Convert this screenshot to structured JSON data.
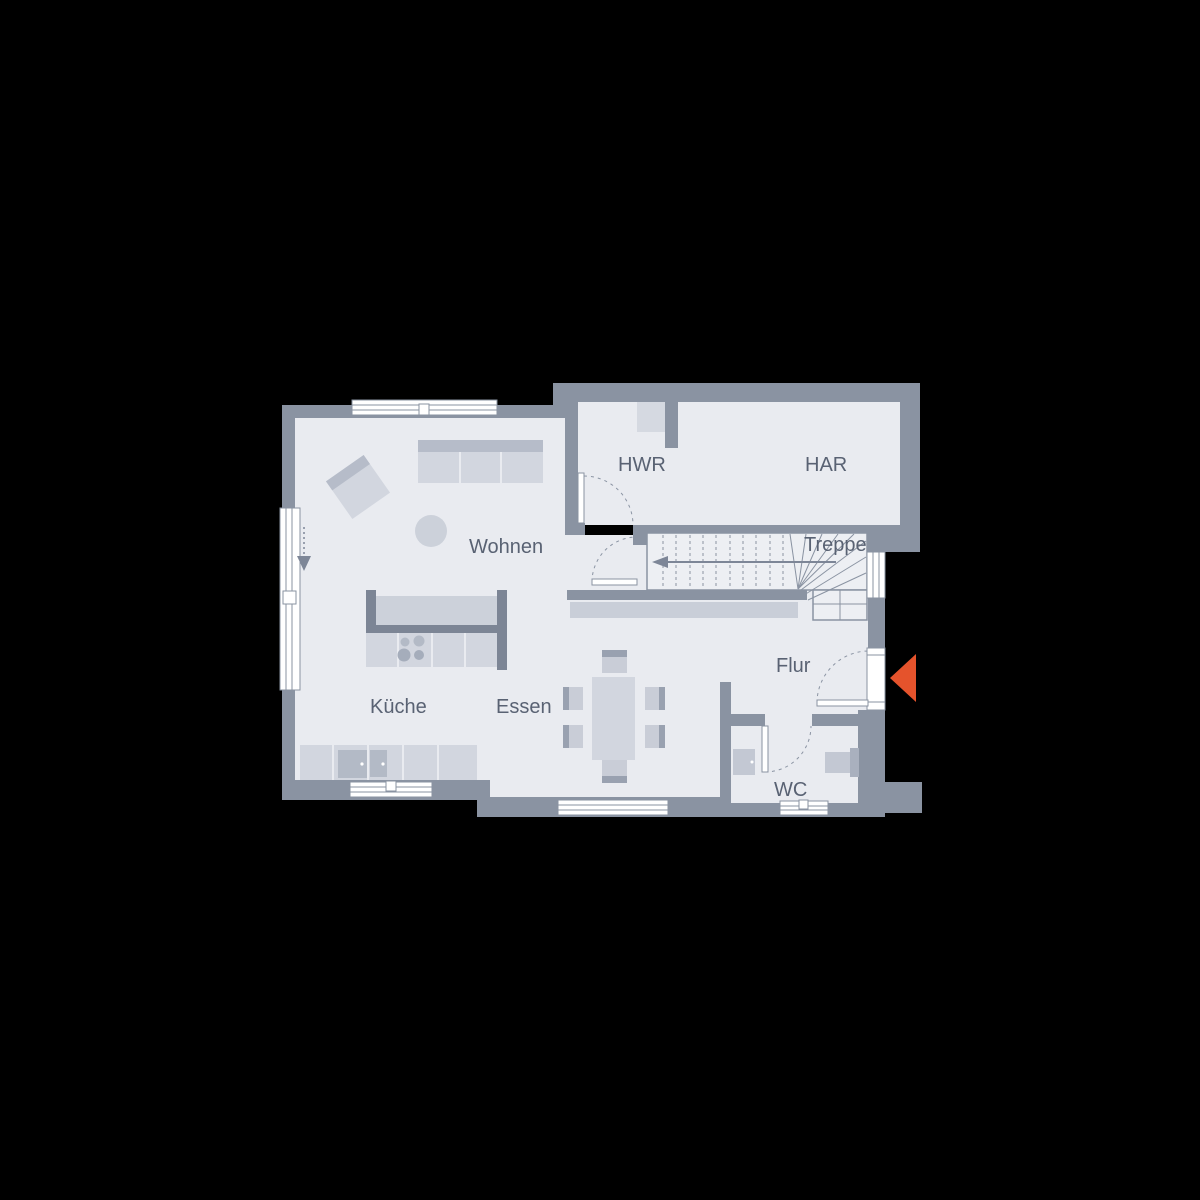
{
  "rooms": {
    "living": "Wohnen",
    "utility_room": "HWR",
    "technical_room": "HAR",
    "staircase": "Treppe",
    "kitchen": "Küche",
    "dining": "Essen",
    "hallway": "Flur",
    "toilet": "WC"
  },
  "icons": {
    "entrance_arrow": "entrance-arrow-icon",
    "section_cut_arrow": "section-cut-arrow-icon",
    "stair_direction_arrow": "stair-direction-arrow-icon"
  },
  "colors": {
    "background": "#000000",
    "wall": "#8a93a2",
    "floor": "#e9ebf0",
    "stair_floor": "#edeff3",
    "furniture_light": "#d2d6df",
    "furniture_medium": "#b6bcc9",
    "furniture_dark": "#7c8595",
    "window_glass": "#ffffff",
    "label_text": "#596273",
    "entrance_arrow": "#e5532c"
  }
}
